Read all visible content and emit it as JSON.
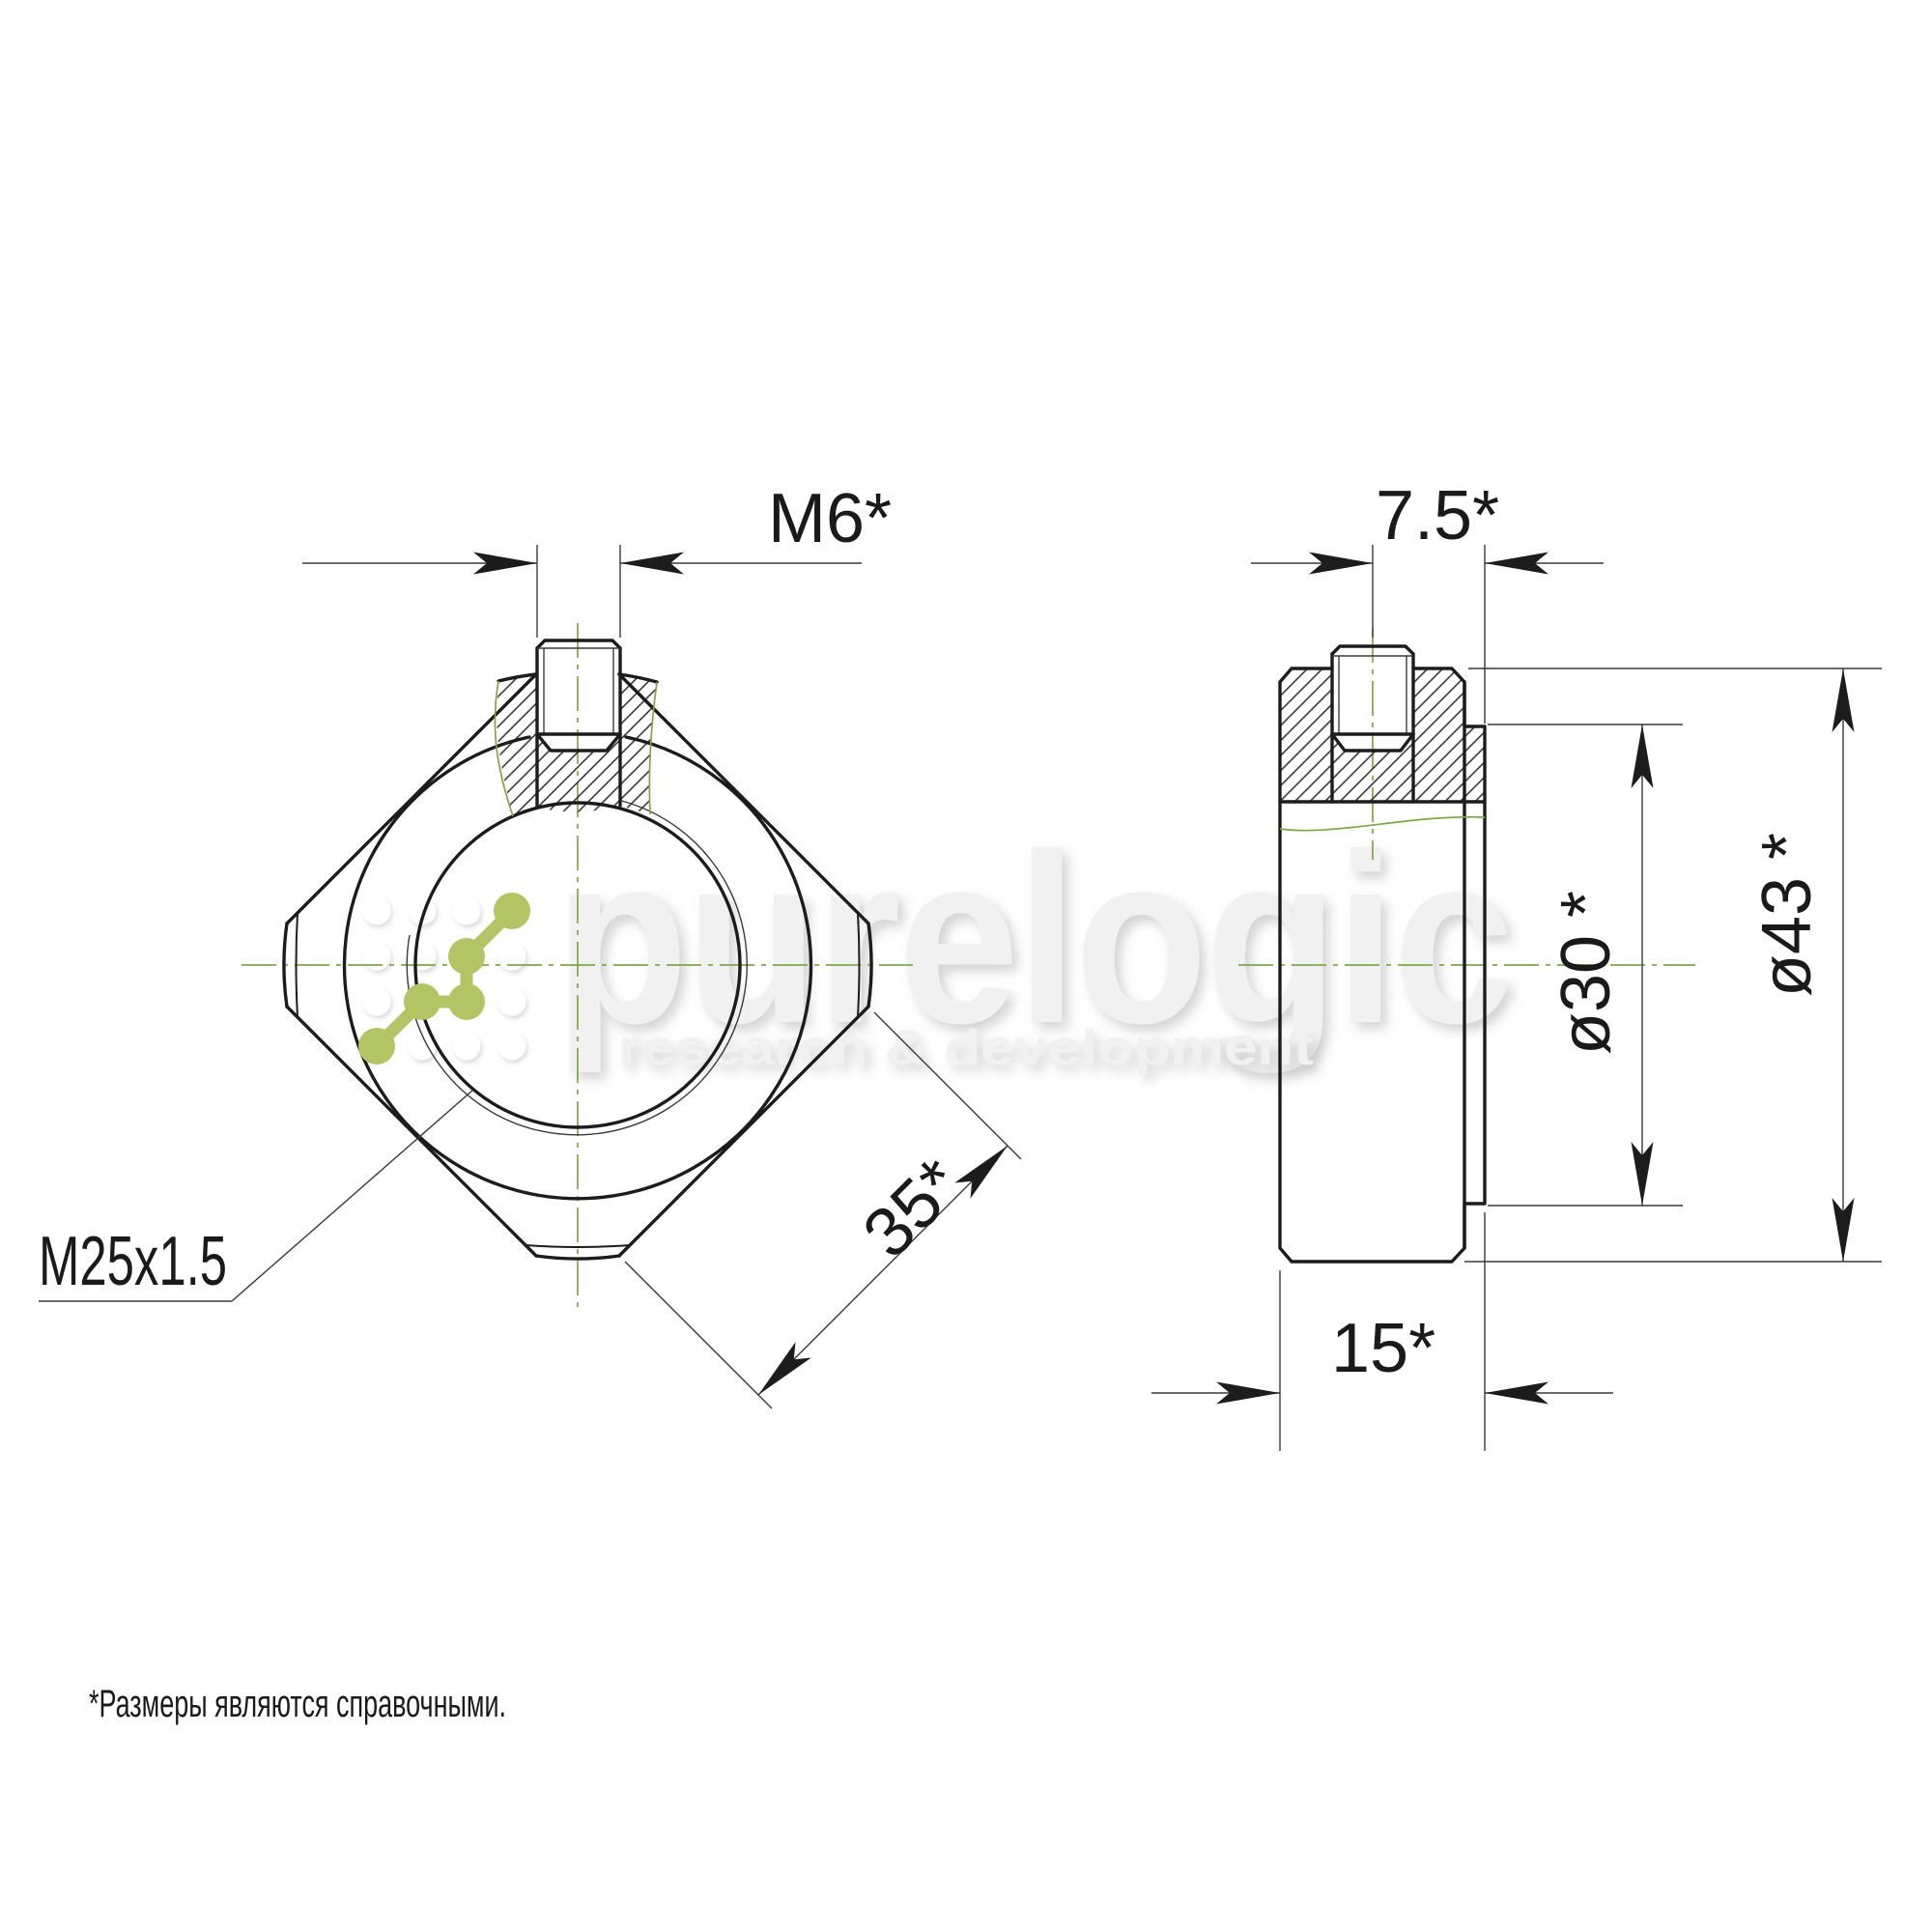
{
  "dimensions": {
    "set_screw": "M6*",
    "screw_offset": "7.5*",
    "boss_dia": "ø30",
    "boss_dia_star": "*",
    "outer_dia": "ø43",
    "outer_dia_star": "*",
    "thickness": "15*",
    "flat_width": "35*",
    "thread_callout": "M25x1.5"
  },
  "footnote": "*Размеры являются справочными.",
  "watermark": {
    "brand": "purelogic",
    "tagline": "research & development"
  },
  "colors": {
    "centerline_green": "#7fa844",
    "logo_green": "#b3c465",
    "main_line": "#1c1c1c",
    "dim_line": "#3a3a3a"
  }
}
